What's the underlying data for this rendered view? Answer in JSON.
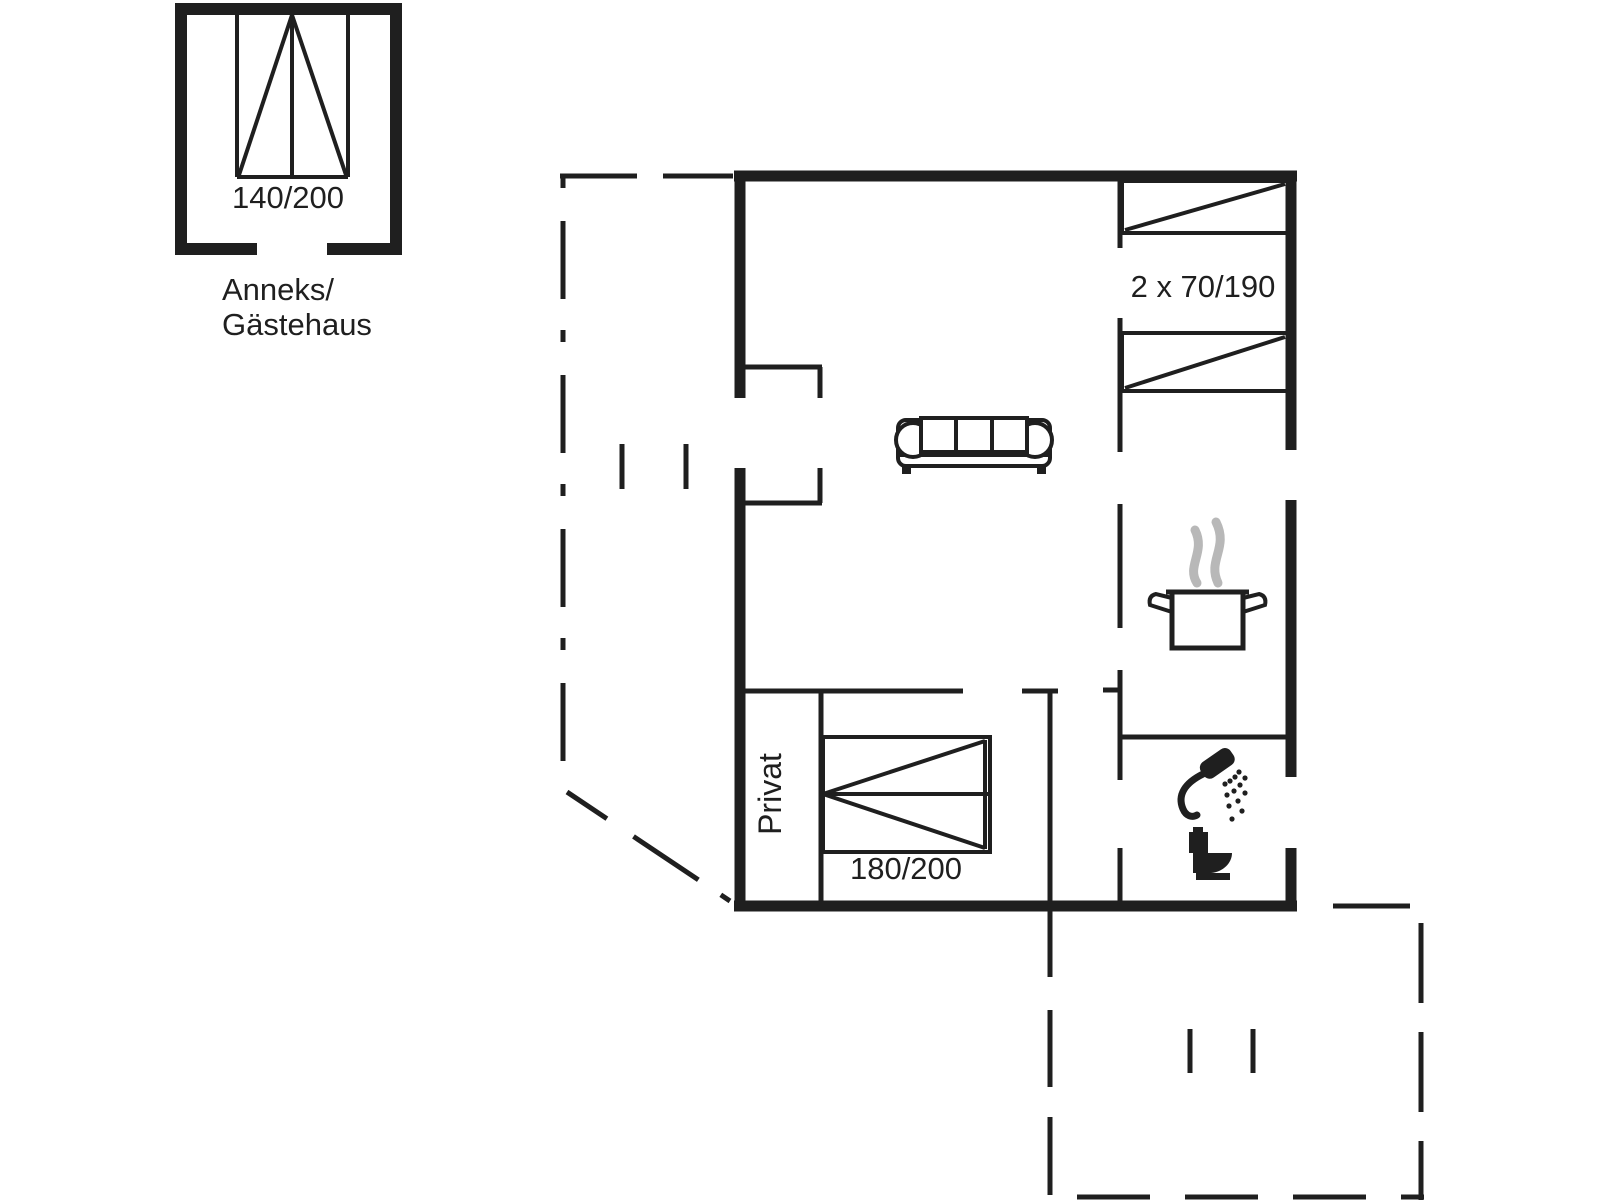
{
  "background_color": "#ffffff",
  "line_color": "#1f1f1f",
  "steam_color": "#b8b8b8",
  "annex": {
    "name_line1": "Anneks/",
    "name_line2": "Gästehaus",
    "bed_size": "140/200"
  },
  "main_house": {
    "bunk_room": {
      "bed_size_label": "2 x 70/190"
    },
    "bedroom": {
      "room_label": "Privat",
      "bed_size_label": "180/200"
    }
  }
}
